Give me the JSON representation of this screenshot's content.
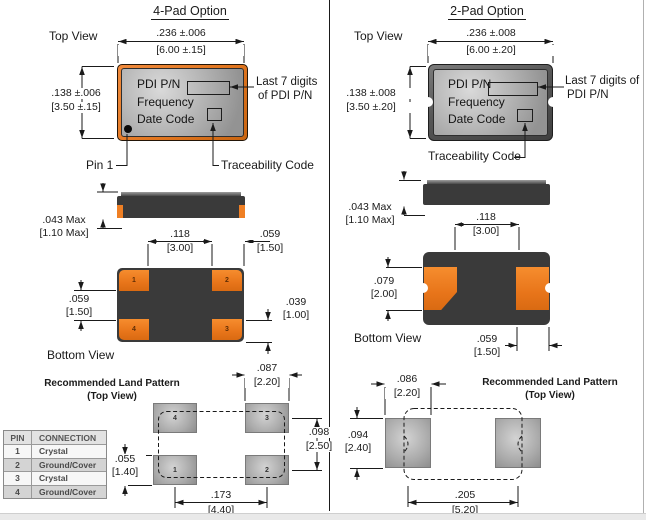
{
  "colors": {
    "pad_orange": "#ef7f24",
    "body_dark": "#3a3a3a",
    "land_pad_gray": "#b5b5b5",
    "line": "#1a1a1a",
    "table_alt": "#d4d4d4",
    "footer_band": "#e9e9e9"
  },
  "left": {
    "title": "4-Pad Option",
    "top_view_label": "Top View",
    "bottom_view_label": "Bottom View",
    "package_marking": {
      "line1": "PDI P/N",
      "line2": "Frequency",
      "line3": "Date Code"
    },
    "callouts": {
      "last7_line1": "Last 7 digits",
      "last7_line2": "of PDI P/N",
      "pin1": "Pin 1",
      "traceability": "Traceability Code"
    },
    "dims": {
      "body_width_in": ".236 ±.006",
      "body_width_mm": "[6.00 ±.15]",
      "body_height_in": ".138 ±.006",
      "body_height_mm": "[3.50 ±.15]",
      "thickness_in": ".043 Max",
      "thickness_mm": "[1.10 Max]",
      "pad_gap_x_in": ".118",
      "pad_gap_x_mm": "[3.00]",
      "pad_width_in": ".059",
      "pad_width_mm": "[1.50]",
      "pad_gap_y_in": ".059",
      "pad_gap_y_mm": "[1.50]",
      "pad_height_in": ".039",
      "pad_height_mm": "[1.00]"
    },
    "bottom_pads": [
      "1",
      "2",
      "4",
      "3"
    ],
    "land_pattern": {
      "title": "Recommended Land Pattern",
      "subtitle": "(Top View)",
      "pad_width_in": ".087",
      "pad_width_mm": "[2.20]",
      "pitch_y_in": ".098",
      "pitch_y_mm": "[2.50]",
      "pad_height_in": ".055",
      "pad_height_mm": "[1.40]",
      "pitch_x_in": ".173",
      "pitch_x_mm": "[4.40]",
      "pads": [
        "4",
        "3",
        "1",
        "2"
      ]
    }
  },
  "right": {
    "title": "2-Pad Option",
    "top_view_label": "Top View",
    "bottom_view_label": "Bottom View",
    "package_marking": {
      "line1": "PDI P/N",
      "line2": "Frequency",
      "line3": "Date Code"
    },
    "callouts": {
      "last7_line1": "Last 7 digits of",
      "last7_line2": "PDI P/N",
      "traceability": "Traceability Code"
    },
    "dims": {
      "body_width_in": ".236 ±.008",
      "body_width_mm": "[6.00 ±.20]",
      "body_height_in": ".138 ±.008",
      "body_height_mm": "[3.50 ±.20]",
      "thickness_in": ".043 Max",
      "thickness_mm": "[1.10 Max]",
      "pad_gap_x_in": ".118",
      "pad_gap_x_mm": "[3.00]",
      "pad_height_in": ".079",
      "pad_height_mm": "[2.00]",
      "pad_width_in": ".059",
      "pad_width_mm": "[1.50]"
    },
    "land_pattern": {
      "title": "Recommended Land Pattern",
      "subtitle": "(Top View)",
      "pad_width_in": ".086",
      "pad_width_mm": "[2.20]",
      "pad_height_in": ".094",
      "pad_height_mm": "[2.40]",
      "pitch_x_in": ".205",
      "pitch_x_mm": "[5.20]"
    }
  },
  "pin_table": {
    "headers": [
      "PIN",
      "CONNECTION"
    ],
    "rows": [
      [
        "1",
        "Crystal"
      ],
      [
        "2",
        "Ground/Cover"
      ],
      [
        "3",
        "Crystal"
      ],
      [
        "4",
        "Ground/Cover"
      ]
    ]
  }
}
